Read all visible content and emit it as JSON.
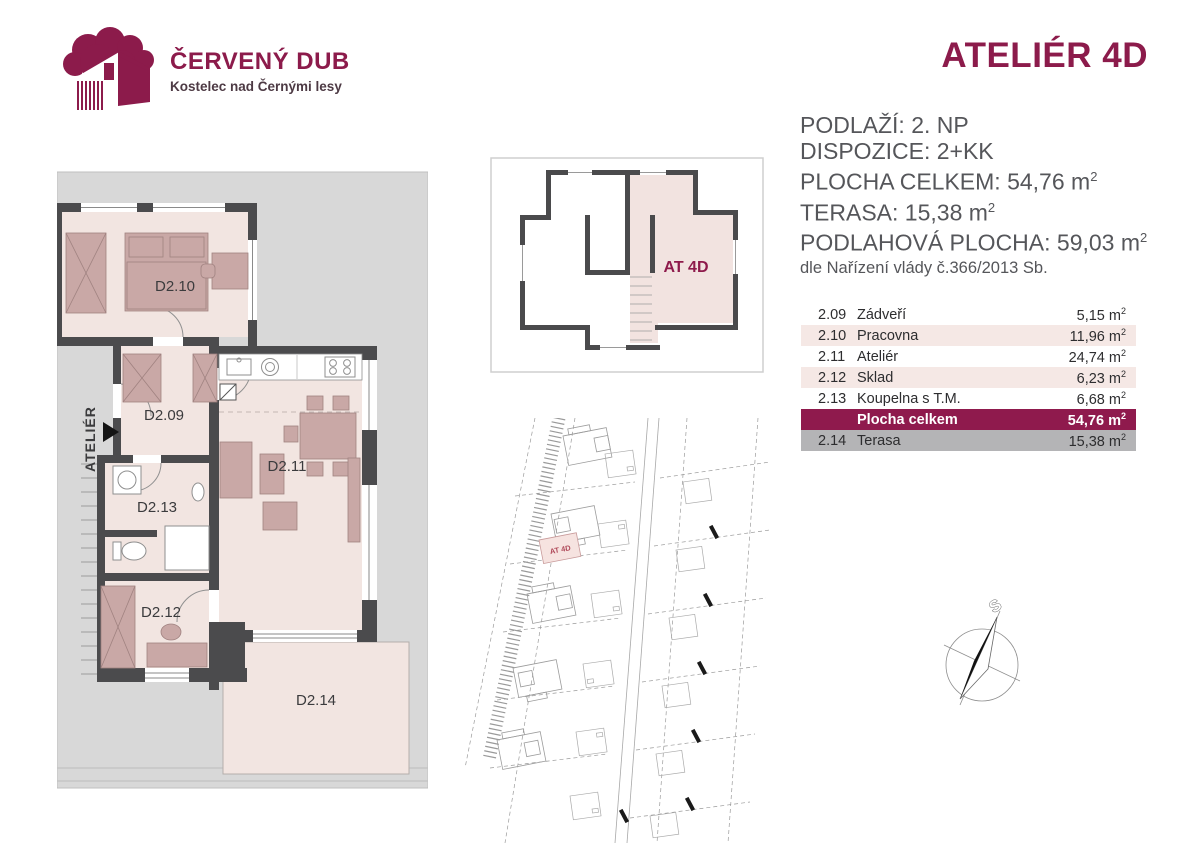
{
  "brand": {
    "name": "ČERVENÝ DUB",
    "subtitle": "Kostelec nad Černými lesy"
  },
  "title": "ATELIÉR 4D",
  "info": {
    "lines": [
      {
        "text": "PODLAŽÍ: 2. NP"
      },
      {
        "text": "DISPOZICE: 2+KK"
      },
      {
        "text": "PLOCHA CELKEM: 54,76 m",
        "sup": "2"
      },
      {
        "text": "TERASA: 15,38 m",
        "sup": "2"
      },
      {
        "text": "PODLAHOVÁ PLOCHA: 59,03 m",
        "sup": "2"
      }
    ],
    "note": "dle Nařízení vlády č.366/2013 Sb."
  },
  "table": {
    "rows": [
      {
        "num": "2.09",
        "name": "Zádveří",
        "area": "5,15 m",
        "sup": "2"
      },
      {
        "num": "2.10",
        "name": "Pracovna",
        "area": "11,96 m",
        "sup": "2"
      },
      {
        "num": "2.11",
        "name": "Ateliér",
        "area": "24,74 m",
        "sup": "2"
      },
      {
        "num": "2.12",
        "name": "Sklad",
        "area": "6,23 m",
        "sup": "2"
      },
      {
        "num": "2.13",
        "name": "Koupelna s T.M.",
        "area": "6,68 m",
        "sup": "2"
      },
      {
        "num": "",
        "name": "Plocha celkem",
        "area": "54,76 m",
        "sup": "2"
      },
      {
        "num": "2.14",
        "name": "Terasa",
        "area": "15,38 m",
        "sup": "2"
      }
    ]
  },
  "floorplan": {
    "entry_label": "ATELIÉR",
    "rooms": {
      "d209": "D2.09",
      "d210": "D2.10",
      "d211": "D2.11",
      "d212": "D2.12",
      "d213": "D2.13",
      "d214": "D2.14"
    }
  },
  "overview": {
    "unit_label": "AT 4D"
  },
  "siteplan": {
    "unit_label": "AT 4D"
  },
  "compass": {
    "north_label": "S"
  },
  "colors": {
    "accent": "#8C1B4B",
    "total_row": "#8F1A4D",
    "row_pink": "#F5E8E5",
    "row_gray": "#B4B4B6",
    "wall": "#4B4B4D",
    "room_fill": "#F2E5E1",
    "furniture": "#C9A8A6",
    "roof": "#D8D8D8"
  }
}
